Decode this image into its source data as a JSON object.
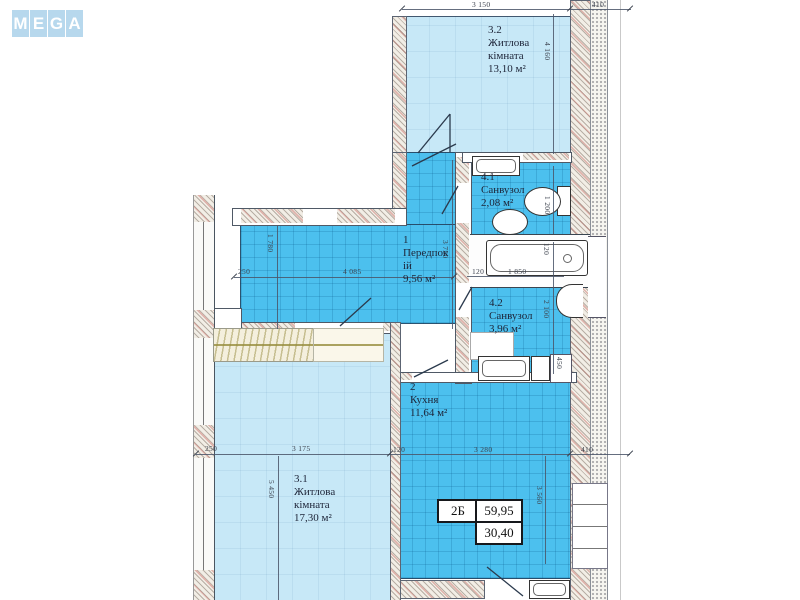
{
  "logo": {
    "letters": [
      "M",
      "E",
      "G",
      "A"
    ]
  },
  "plan": {
    "rooms": [
      {
        "id": "hall",
        "number": "1",
        "name": "Передпокій",
        "area": "9,56 м²"
      },
      {
        "id": "kitchen",
        "number": "2",
        "name": "Кухня",
        "area": "11,64 м²"
      },
      {
        "id": "living1",
        "number": "3.1",
        "name": "Житлова кімната",
        "area": "17,30 м²"
      },
      {
        "id": "living2",
        "number": "3.2",
        "name": "Житлова кімната",
        "area": "13,10 м²"
      },
      {
        "id": "bath1",
        "number": "4.1",
        "name": "Санвузол",
        "area": "2,08 м²"
      },
      {
        "id": "bath2",
        "number": "4.2",
        "name": "Санвузол",
        "area": "3,96 м²"
      }
    ],
    "info_table": {
      "unit": "2Б",
      "total_area": "59,95",
      "living_area": "30,40"
    },
    "dimensions": [
      {
        "text": "3 150",
        "x": 472,
        "y": 0
      },
      {
        "text": "410",
        "x": 592,
        "y": 0
      },
      {
        "text": "4 160",
        "x": 552,
        "y": 42,
        "v": true
      },
      {
        "text": "1 200",
        "x": 552,
        "y": 196,
        "v": true
      },
      {
        "text": "120",
        "x": 472,
        "y": 267
      },
      {
        "text": "1 850",
        "x": 508,
        "y": 267
      },
      {
        "text": "120",
        "x": 551,
        "y": 243,
        "v": true
      },
      {
        "text": "2 100",
        "x": 551,
        "y": 300,
        "v": true
      },
      {
        "text": "450",
        "x": 564,
        "y": 357,
        "v": true
      },
      {
        "text": "250",
        "x": 238,
        "y": 267
      },
      {
        "text": "4 085",
        "x": 343,
        "y": 267
      },
      {
        "text": "1 780",
        "x": 275,
        "y": 234,
        "v": true
      },
      {
        "text": "3 750",
        "x": 450,
        "y": 240,
        "v": true
      },
      {
        "text": "250",
        "x": 205,
        "y": 444
      },
      {
        "text": "3 175",
        "x": 292,
        "y": 444
      },
      {
        "text": "120",
        "x": 393,
        "y": 445
      },
      {
        "text": "3 280",
        "x": 474,
        "y": 445
      },
      {
        "text": "410",
        "x": 581,
        "y": 445
      },
      {
        "text": "5 450",
        "x": 276,
        "y": 480,
        "v": true
      },
      {
        "text": "3 560",
        "x": 544,
        "y": 486,
        "v": true
      }
    ],
    "colors": {
      "room_light": "#c7e8f7",
      "room_dark": "#4cc0ee",
      "logo_blue": "#b7d8ed",
      "label": "#1d2438",
      "dim": "#3c424e",
      "line": "#4a5568"
    }
  }
}
